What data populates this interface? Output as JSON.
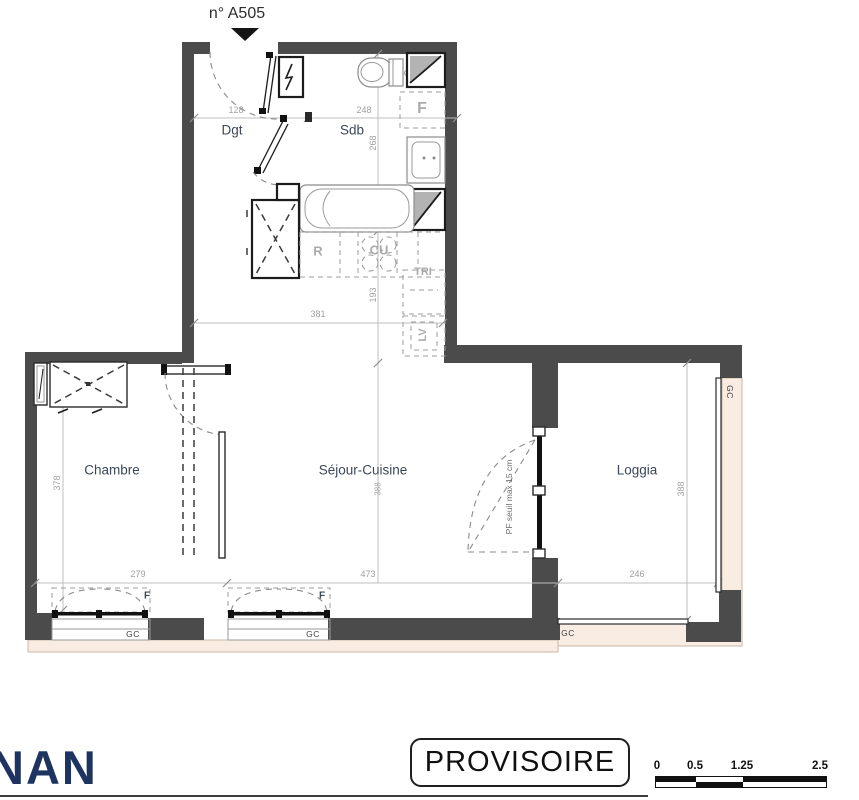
{
  "header": {
    "unit_number": "n° A505"
  },
  "rooms": {
    "dgt": "Dgt",
    "sdb": "Sdb",
    "chambre": "Chambre",
    "sejour": "Séjour-Cuisine",
    "loggia": "Loggia"
  },
  "dims": {
    "dgt_width": "128",
    "sdb_width": "248",
    "sdb_height": "268",
    "upper_width": "381",
    "kitchen_height": "193",
    "chambre_height": "378",
    "sejour_height": "388",
    "chambre_width": "279",
    "sejour_width": "473",
    "loggia_width": "246",
    "loggia_height": "388"
  },
  "annotations": {
    "fridge": "R",
    "cooktop": "CU",
    "waste_sorting": "TRI",
    "dishwasher": "LV",
    "duct": "F",
    "window": "F",
    "guardrail": "GC",
    "pf_note": "PF seuil max 15 cm"
  },
  "footer": {
    "logo": "NAN",
    "stamp": "PROVISOIRE",
    "scale_labels": [
      "0",
      "0.5",
      "1.25",
      "2.5"
    ]
  },
  "colors": {
    "wall": "#4b4b4b",
    "beige": "#f8ece3",
    "navy": "#1d3460"
  }
}
